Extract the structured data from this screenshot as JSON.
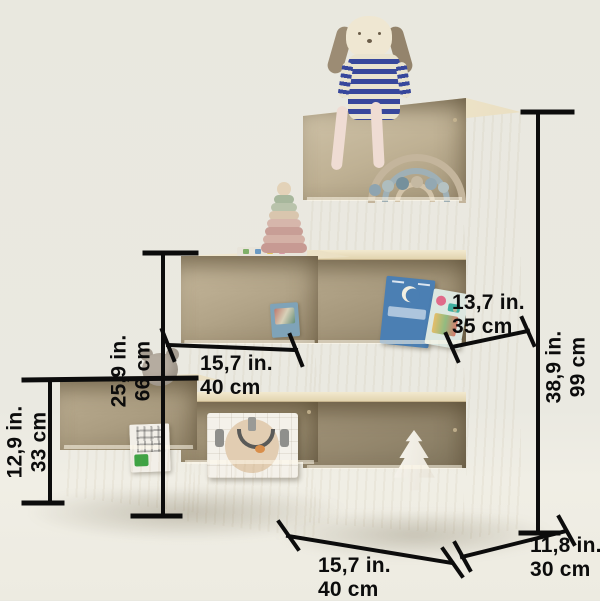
{
  "measurements": {
    "shelf1_height": {
      "in": "12,9 in.",
      "cm": "33 cm"
    },
    "shelf2_height": {
      "in": "25,9 in.",
      "cm": "66 cm"
    },
    "total_height": {
      "in": "38,9 in.",
      "cm": "99 cm"
    },
    "bin_width": {
      "in": "15,7 in.",
      "cm": "40 cm"
    },
    "base_width": {
      "in": "15,7 in.",
      "cm": "40 cm"
    },
    "upper_depth": {
      "in": "13,7 in.",
      "cm": "35 cm"
    },
    "base_depth": {
      "in": "11,8 in.",
      "cm": "30 cm"
    }
  },
  "objects": [
    "dog plush in navy striped sweater",
    "wooden stacking ring pyramid",
    "rainbow arch toy",
    "wooden bead garland",
    "picture books",
    "toy sink box",
    "white christmas tree",
    "puzzle box",
    "grey plush"
  ],
  "colors": {
    "background": "#E9E8E0",
    "wood_light": "#F0E8D0",
    "wood_mid": "#E3D4AF",
    "wood_dark": "#9A8C70",
    "annotation": "#0C0C0C",
    "dog_stripe": "#37479C"
  }
}
